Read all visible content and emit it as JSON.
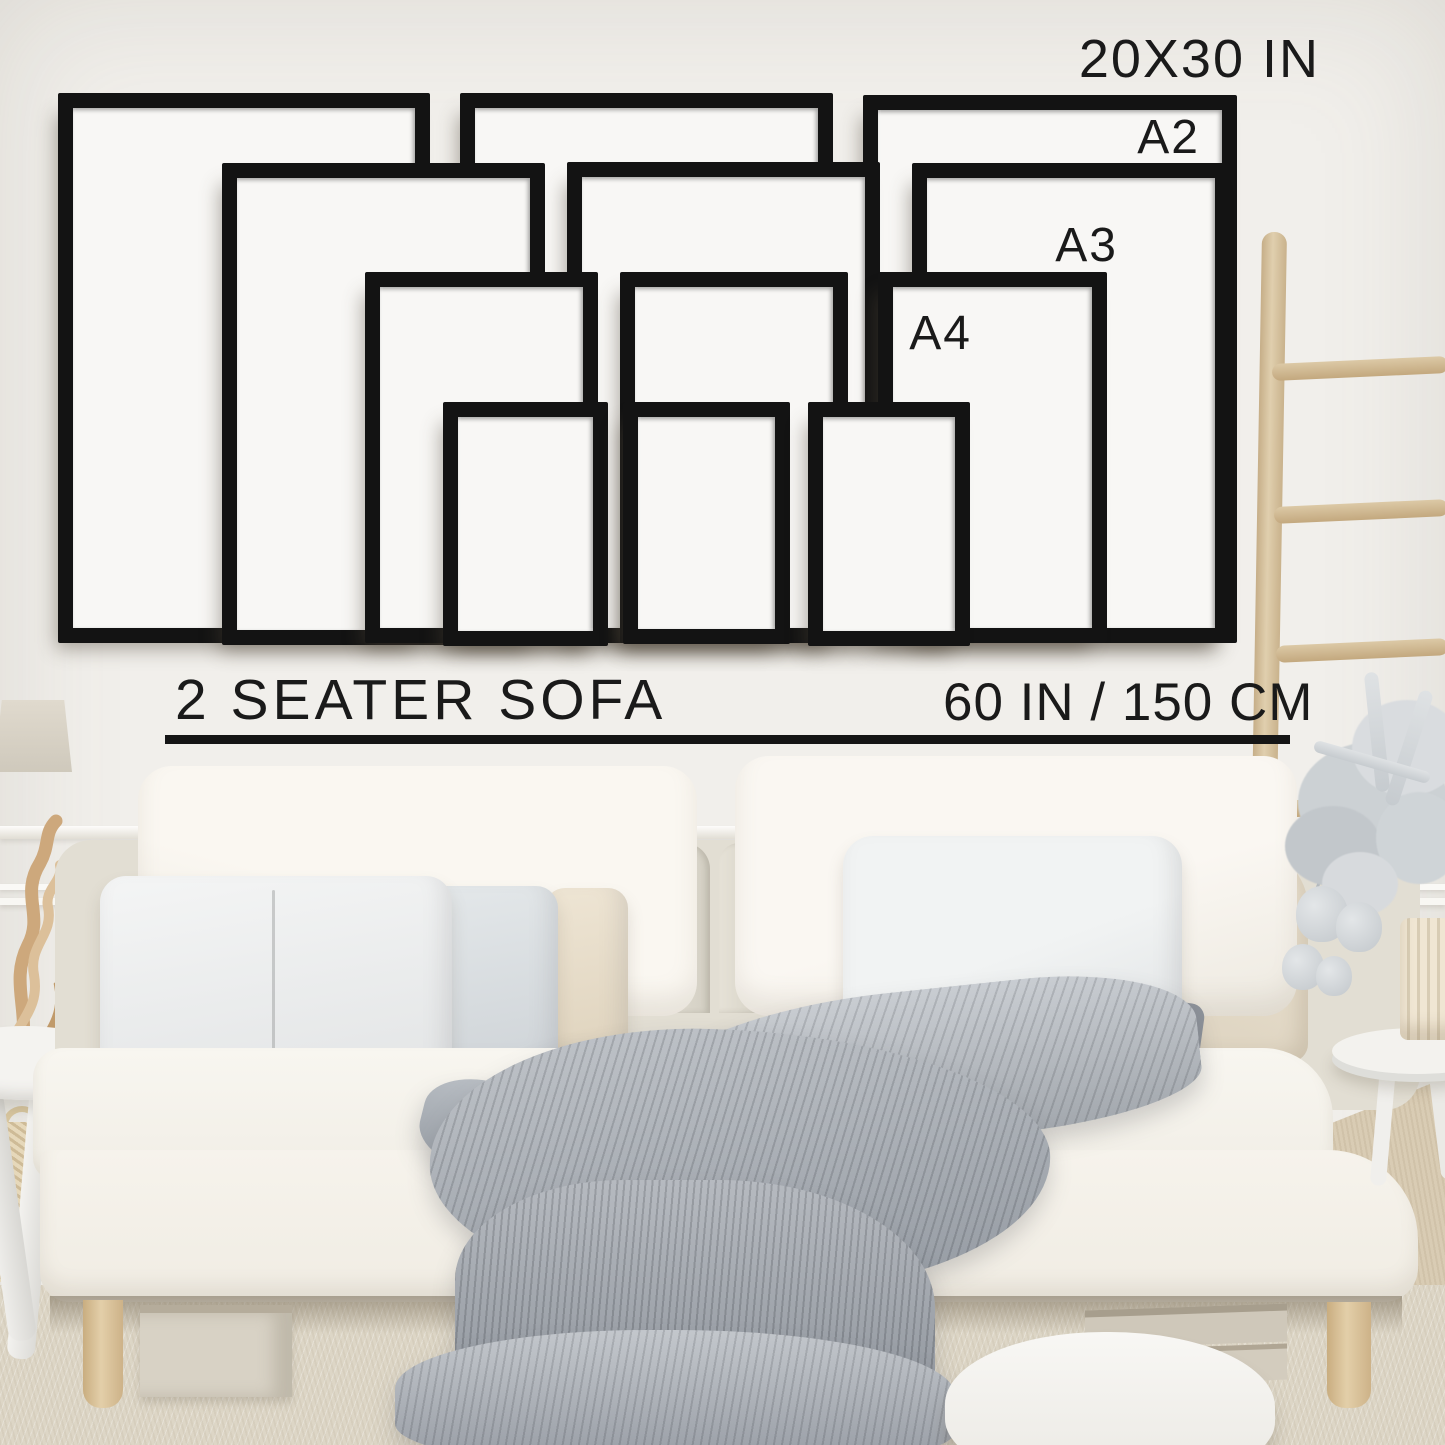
{
  "page": {
    "kind": "wall-art-frame-size-guide"
  },
  "labels": {
    "top_size": "20X30 IN",
    "a2": "A2",
    "a3": "A3",
    "a4": "A4",
    "sofa": "2 SEATER SOFA",
    "sofa_width": "60 IN / 150 CM"
  },
  "frame_sizes": [
    {
      "label": "20X30 IN",
      "frames_shown": 3
    },
    {
      "label": "A2",
      "frames_shown": 3
    },
    {
      "label": "A3",
      "frames_shown": 3
    },
    {
      "label": "A4",
      "frames_shown": 3
    }
  ],
  "scene_objects": {
    "sofa": "white two seater sofa with pillows and grey knit throw blanket",
    "ladder": "wooden blanket ladder",
    "plant": "silver dried eucalyptus in ribbed vase on round side table",
    "decor_left": "lampshade, driftwood sculpture, woven basket, round side table"
  },
  "colors": {
    "frame": "#131313",
    "frame_inner": "#f8f7f5",
    "text": "#1a1a1a",
    "underline": "#151515",
    "wall": "#f1efeb",
    "sofa": "#f6f3ed",
    "blanket": "#a6abb1",
    "wood": "#d9c5a2",
    "carpet": "#ddd6c6"
  }
}
